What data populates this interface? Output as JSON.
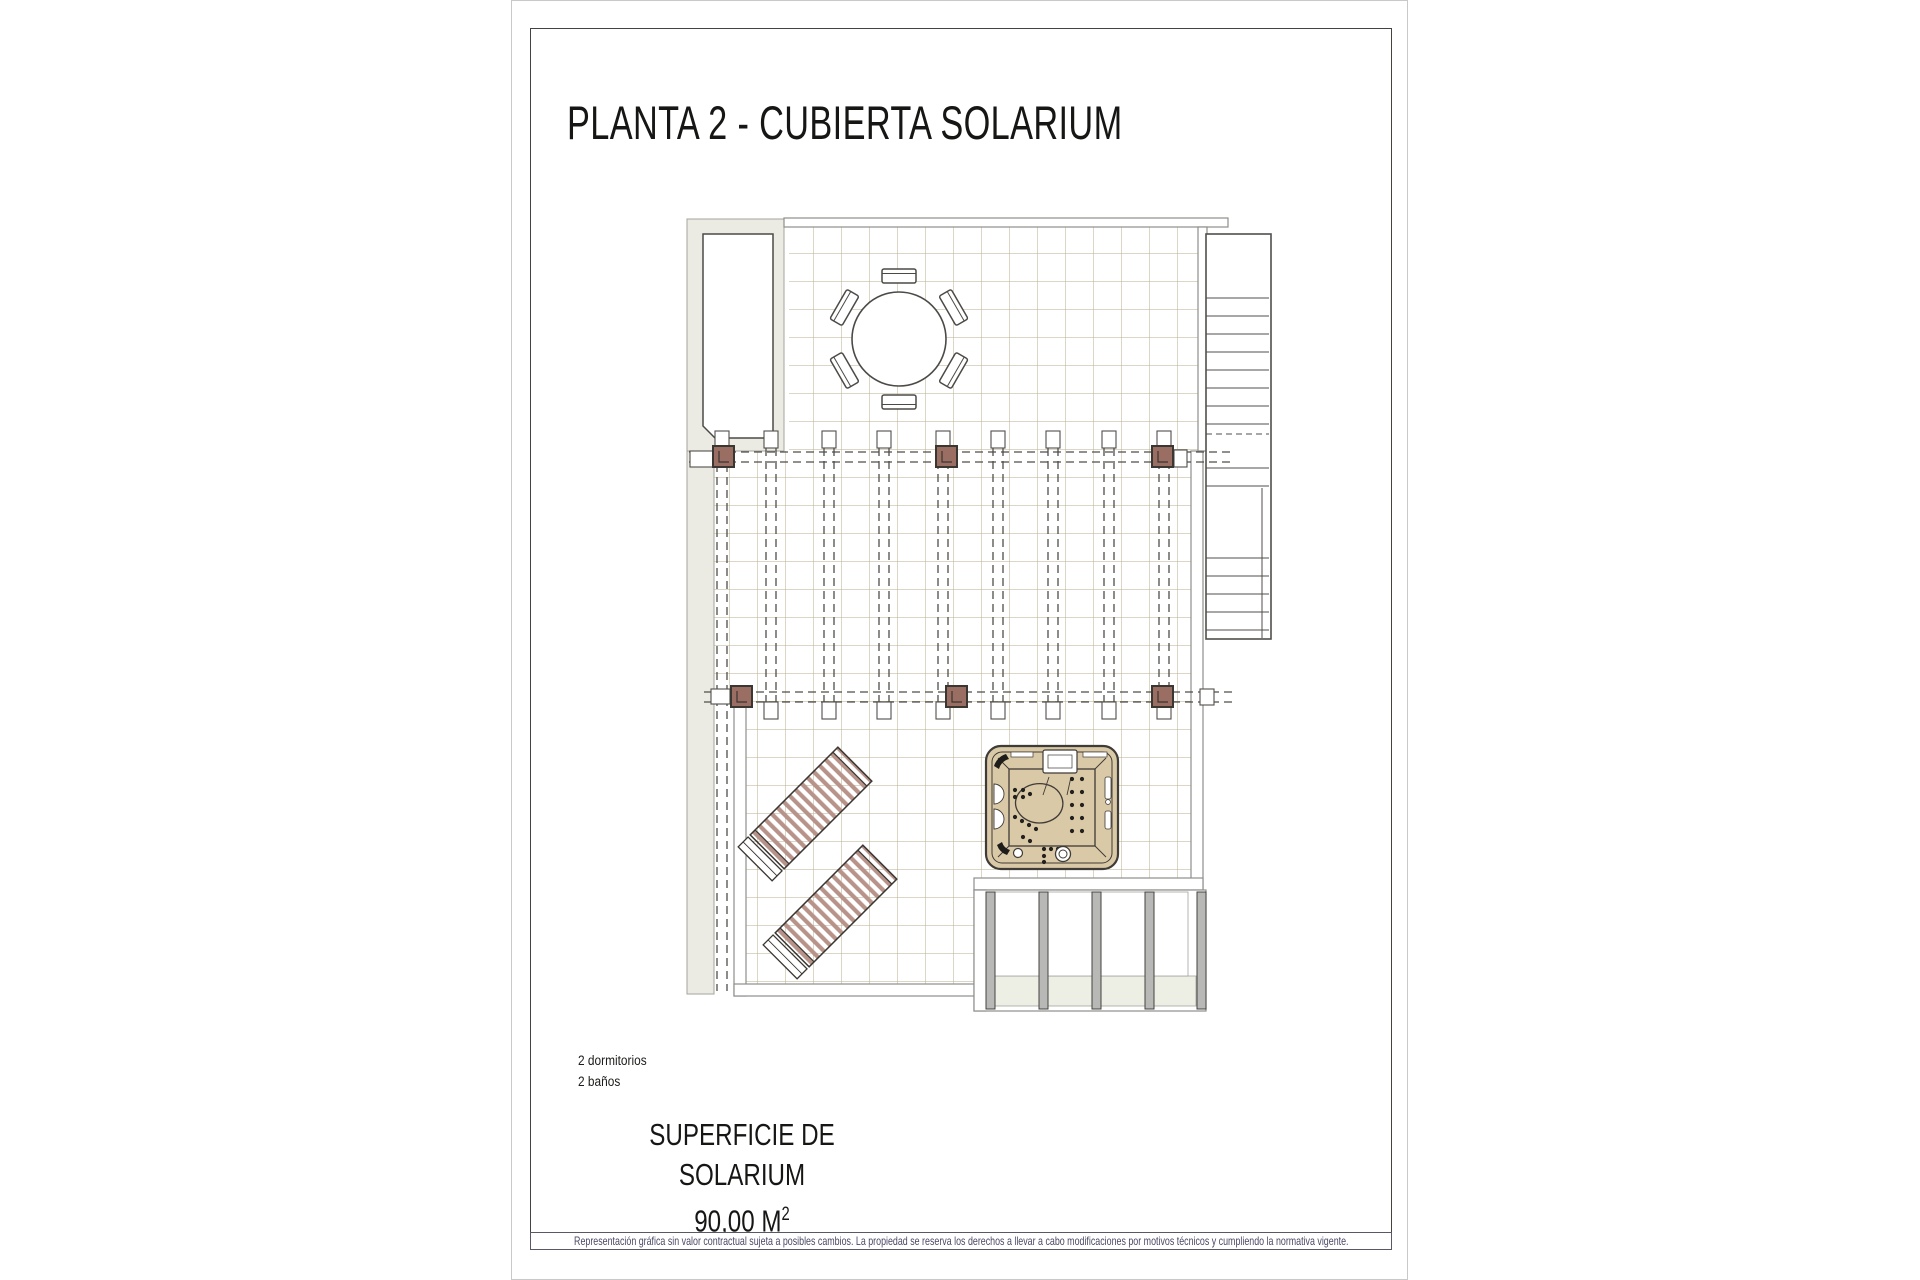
{
  "page": {
    "title": "PLANTA 2 - CUBIERTA SOLARIUM"
  },
  "annotations": {
    "bedrooms": "2 dormitorios",
    "bathrooms": "2 baños"
  },
  "surface": {
    "label": "SUPERFICIE DE SOLARIUM",
    "value": "90,00 M",
    "superscript": "2"
  },
  "disclaimer": "Representación gráfica sin valor contractual sujeta a posibles cambios. La propiedad se reserva los derechos a llevar a cabo modificaciones por motivos técnicos y cumpliendo la normativa vigente.",
  "colors": {
    "tile_line": "#b9ae8f",
    "wall_gray": "#8e8e8a",
    "dark_line": "#4f4d49",
    "gray_zone": "#ecebe3",
    "post_brown": "#9a6e62",
    "lounger_stripe": "#b8938a",
    "hot_tub_tan": "#dac9a7",
    "porch_column_gray": "#b8b8b6",
    "disclaimer_text": "#4a4865"
  },
  "plan": {
    "features": [
      "dining-table-6-chairs",
      "pergola-posts",
      "pergola-beams",
      "stairs",
      "sun-loungers",
      "hot-tub",
      "porch-columns",
      "rooftop-tiles"
    ]
  }
}
